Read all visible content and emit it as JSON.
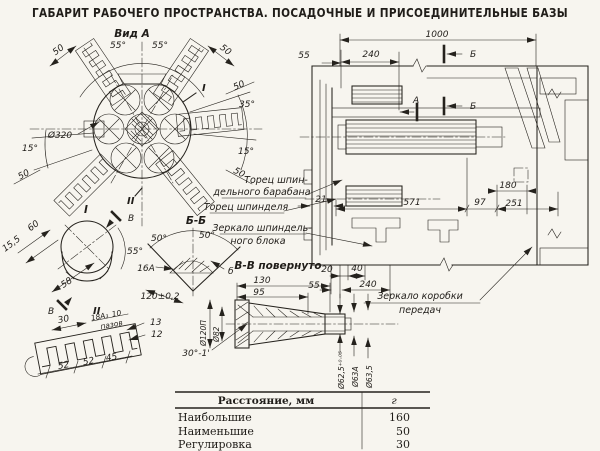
{
  "title": "ГАБАРИТ РАБОЧЕГО ПРОСТРАНСТВА.  ПОСАДОЧНЫЕ И ПРИСОЕДИНИТЕЛЬНЫЕ БАЗЫ",
  "colors": {
    "ink": "#25221d",
    "paper": "#f7f5ef"
  },
  "vid_a": {
    "label": "Вид А",
    "angle_55_left": "55°",
    "angle_55_right": "55°",
    "angle_35": "35°",
    "angle_15_right": "15°",
    "angle_15_left": "15°",
    "dia_320": "Ø320",
    "d50_top_left": "50",
    "d50_top_right": "50",
    "d50_right": "50",
    "d50_right_lower": "50",
    "d50_bottom_left": "50",
    "detail_mark_1": "I",
    "detail_mark_2": "II"
  },
  "detail_1": {
    "title": "I",
    "dim_60": "60",
    "dim_15_5": "15,5",
    "dim_58": "58",
    "angle_55": "55°",
    "section_v_top": "В",
    "section_v_bottom": "В",
    "detail_mark_2": "II"
  },
  "section_bb": {
    "title": "Б-Б",
    "angle_50_left": "50°",
    "angle_50_right": "50°",
    "fit_16a": "16А",
    "dim_120": "120±0,2",
    "ref_b": "б"
  },
  "section_vv": {
    "title": "В-В повернуто",
    "dim_130": "130",
    "dim_95": "95",
    "dia_120": "Ø120П",
    "dia_82": "Ø82",
    "angle_30": "30°-1'",
    "dia_62_5": "Ø62,5⁺⁰·⁰⁵",
    "dia_63a": "Ø63А",
    "dia_63_5": "Ø63,5"
  },
  "detail_2": {
    "dim_30": "30",
    "fit_18a3": "18А₃",
    "dim_10": "10",
    "word_slots": "пазов",
    "dim_13": "13",
    "dim_12": "12",
    "dim_52a": "52",
    "dim_52b": "52",
    "dim_45": "45"
  },
  "main_view": {
    "dim_1000": "1000",
    "dim_55_top": "55",
    "dim_240_top": "240",
    "sec_b_top": "Б",
    "sec_b_mid": "Б",
    "sec_a": "А",
    "dim_571": "571",
    "dim_97": "97",
    "dim_251": "251",
    "dim_180": "180",
    "dim_21": "21",
    "dim_20": "20",
    "dim_40": "40",
    "dim_55_bottom": "55",
    "dim_240_bottom": "240",
    "label_spindle_drum_face_1": "Торец шпин-",
    "label_spindle_drum_face_2": "дельного барабана",
    "label_spindle_face": "Торец шпинделя",
    "label_spindle_block_1": "Зеркало шпиндель-",
    "label_spindle_block_2": "ного блока",
    "label_gearbox_1": "Зеркало коробки",
    "label_gearbox_2": "передач"
  },
  "table": {
    "header_distance": "Расстояние, мм",
    "header_value": "г",
    "rows": [
      {
        "label": "Наибольшие",
        "value": "160"
      },
      {
        "label": "Наименьшие",
        "value": "50"
      },
      {
        "label": "Регулировка",
        "value": "30"
      }
    ]
  }
}
